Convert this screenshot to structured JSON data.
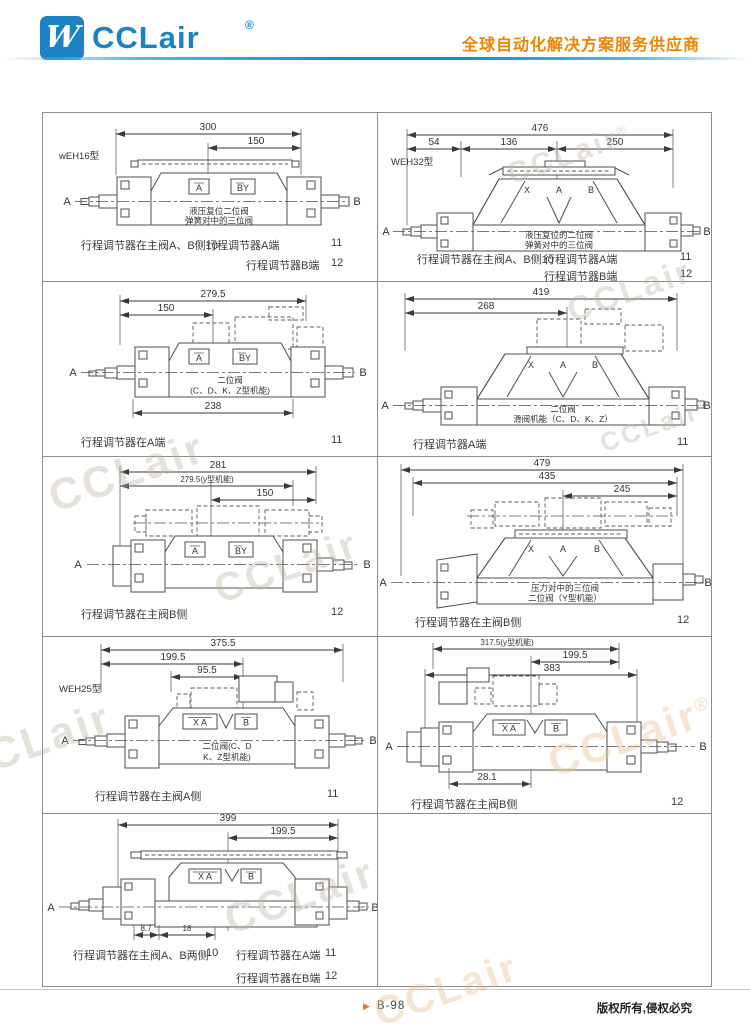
{
  "header": {
    "brand": "CCLair",
    "registered": "®",
    "logo_glyph": "W",
    "tagline": "全球自动化解决方案服务供应商"
  },
  "end_labels": {
    "left": "A",
    "right": "B"
  },
  "watermark": {
    "text": "CCLair",
    "reg": "®"
  },
  "panels": {
    "r1l": {
      "model": "wEH16型",
      "dims": [
        "300",
        "150"
      ],
      "ports": [
        "A",
        "BY"
      ],
      "notes": [
        "液压复位二位阀",
        "弹簧对中的三位阀"
      ],
      "cap1a": "行程调节器在主阀A、B侧10",
      "cap1b": "行程调节器A端",
      "cap1n": "11",
      "cap2a": "行程调节器B端",
      "cap2n": "12"
    },
    "r1r": {
      "model": "WEH32型",
      "dims": [
        "476",
        "54",
        "136",
        "250"
      ],
      "ports": [
        "X",
        "A",
        "B"
      ],
      "notes": [
        "液压复位的二位阀",
        "弹簧对中的三位阀"
      ],
      "cap1a": "行程调节器在主阀A、B侧10",
      "cap1b": "行程调节器A端",
      "cap1n": "11",
      "cap2a": "行程调节器B端",
      "cap2n": "12"
    },
    "r2l": {
      "dims": [
        "279.5",
        "150",
        "238"
      ],
      "ports": [
        "A",
        "BY"
      ],
      "notes": [
        "二位阀",
        "(C、D、K、Z型机能)"
      ],
      "cap1a": "行程调节器在A端",
      "cap1n": "11"
    },
    "r2r": {
      "dims": [
        "419",
        "268"
      ],
      "ports": [
        "X",
        "A",
        "B"
      ],
      "notes": [
        "二位阀",
        "滑阀机能（C、D、K、Z）"
      ],
      "cap1a": "行程调节器A端",
      "cap1n": "11"
    },
    "r3l": {
      "dims": [
        "281",
        "279.5(y型机能)",
        "150"
      ],
      "ports": [
        "A",
        "BY"
      ],
      "cap1a": "行程调节器在主阀B侧",
      "cap1n": "12"
    },
    "r3r": {
      "dims": [
        "479",
        "435",
        "245"
      ],
      "ports": [
        "X",
        "A",
        "B"
      ],
      "notes": [
        "压力对中的三位阀",
        "二位阀（Y型机能）"
      ],
      "cap1a": "行程调节器在主阀B侧",
      "cap1n": "12"
    },
    "r4l": {
      "model": "WEH25型",
      "dims": [
        "375.5",
        "199.5",
        "95.5"
      ],
      "ports": [
        "X A",
        "B"
      ],
      "notes": [
        "二位阀(C、D",
        "K、Z型机能)"
      ],
      "cap1a": "行程调节器在主阀A侧",
      "cap1n": "11"
    },
    "r4r": {
      "dims": [
        "317.5(y型机能)",
        "199.5",
        "383",
        "28.1"
      ],
      "ports": [
        "X A",
        "B"
      ],
      "cap1a": "行程调节器在主阀B侧",
      "cap1n": "12"
    },
    "r5l": {
      "dims": [
        "399",
        "199.5",
        "8.7",
        "18"
      ],
      "ports": [
        "X A",
        "B"
      ],
      "cap1a": "行程调节器在主阀A、B两侧",
      "cap1n": "10",
      "cap1b": "行程调节器在A端",
      "cap1bn": "11",
      "cap2b": "行程调节器在B端",
      "cap2bn": "12"
    }
  },
  "footer": {
    "marker": "▶",
    "page": "B-98",
    "copyright": "版权所有,侵权必究"
  }
}
